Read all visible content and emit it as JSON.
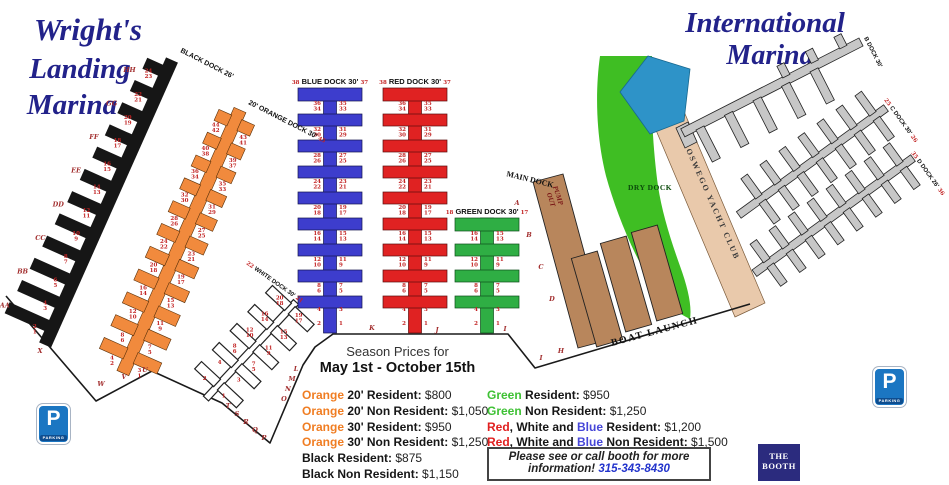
{
  "titles": {
    "left1": "Wright's",
    "left2": "Landing",
    "left3": "Marina",
    "right1": "International",
    "right2": "Marina"
  },
  "season": {
    "l1": "Season Prices for",
    "l2": "May 1st - October 15th"
  },
  "prices_left": [
    [
      {
        "t": "Orange",
        "c": "orange"
      },
      {
        "t": " 20' Resident: ",
        "c": "k"
      },
      {
        "t": "$800",
        "c": "v"
      }
    ],
    [
      {
        "t": "Orange",
        "c": "orange"
      },
      {
        "t": " 20' Non Resident: ",
        "c": "k"
      },
      {
        "t": "$1,050",
        "c": "v"
      }
    ],
    [
      {
        "t": "Orange",
        "c": "orange"
      },
      {
        "t": " 30' Resident: ",
        "c": "k"
      },
      {
        "t": "$950",
        "c": "v"
      }
    ],
    [
      {
        "t": "Orange",
        "c": "orange"
      },
      {
        "t": " 30' Non Resident: ",
        "c": "k"
      },
      {
        "t": "$1,250",
        "c": "v"
      }
    ],
    [
      {
        "t": "Black",
        "c": "k"
      },
      {
        "t": " Resident: ",
        "c": "k"
      },
      {
        "t": "$875",
        "c": "v"
      }
    ],
    [
      {
        "t": "Black",
        "c": "k"
      },
      {
        "t": " Non Resident: ",
        "c": "k"
      },
      {
        "t": "$1,150",
        "c": "v"
      }
    ]
  ],
  "prices_right": [
    [
      {
        "t": "Green",
        "c": "green"
      },
      {
        "t": " Resident: ",
        "c": "k"
      },
      {
        "t": "$950",
        "c": "v"
      }
    ],
    [
      {
        "t": "Green",
        "c": "green"
      },
      {
        "t": " Non Resident: ",
        "c": "k"
      },
      {
        "t": "$1,250",
        "c": "v"
      }
    ],
    [
      {
        "t": "Red",
        "c": "red"
      },
      {
        "t": ", White and ",
        "c": "k"
      },
      {
        "t": "Blue",
        "c": "blue"
      },
      {
        "t": " Resident: ",
        "c": "k"
      },
      {
        "t": "$1,200",
        "c": "v"
      }
    ],
    [
      {
        "t": "Red",
        "c": "red"
      },
      {
        "t": ", White and ",
        "c": "k"
      },
      {
        "t": "Blue",
        "c": "blue"
      },
      {
        "t": " Non Resident: ",
        "c": "k"
      },
      {
        "t": "$1,500",
        "c": "v"
      }
    ]
  ],
  "notice": {
    "l1": "Please see or call booth for more",
    "l2a": "information! ",
    "phone": "315-343-8430"
  },
  "booth": {
    "l1": "THE",
    "l2": "BOOTH"
  },
  "parking": {
    "p": "P",
    "label": "PARKING"
  },
  "map_labels": {
    "black": {
      "title": "BLACK DOCK 26'"
    },
    "orange": {
      "title": "20' ORANGE DOCK 30'",
      "num": "45"
    },
    "white": {
      "nl": "22",
      "title": "WHITE DOCK 30'",
      "nr": "21"
    },
    "blue": {
      "nl": "38",
      "title": "BLUE DOCK 30'",
      "nr": "37"
    },
    "red": {
      "nl": "38",
      "title": "RED DOCK 30'",
      "nr": "37"
    },
    "green": {
      "nl": "18",
      "title": "GREEN DOCK 30'",
      "nr": "17"
    },
    "main_dock": "MAIN DOCK",
    "pump1": "PUMP",
    "pump2": "OUT",
    "boat_launch": "BOAT LAUNCH",
    "dry_dock": "DRY DOCK",
    "yacht_club": "OSWEGO YACHT CLUB",
    "b_dock": "B DOCK 30'",
    "c_dock": {
      "nl": "25",
      "title": "C DOCK 30'",
      "nr": "26"
    },
    "d_dock": {
      "nl": "35",
      "title": "D DOCK 26'",
      "nr": "36"
    }
  },
  "slip_numbers": {
    "vpairs": [
      [
        "36",
        "34",
        "35",
        "33"
      ],
      [
        "32",
        "30",
        "31",
        "29"
      ],
      [
        "28",
        "26",
        "27",
        "25"
      ],
      [
        "24",
        "22",
        "23",
        "21"
      ],
      [
        "20",
        "18",
        "19",
        "17"
      ],
      [
        "16",
        "14",
        "15",
        "13"
      ],
      [
        "12",
        "10",
        "11",
        "9"
      ],
      [
        "8",
        "6",
        "7",
        "5"
      ]
    ],
    "vsingles": [
      [
        "4",
        "3"
      ],
      [
        "2",
        "1"
      ]
    ],
    "green_pairs": [
      [
        "16",
        "14",
        "15",
        "13"
      ],
      [
        "12",
        "10",
        "11",
        "9"
      ],
      [
        "8",
        "6",
        "7",
        "5"
      ]
    ],
    "black_pairs": [
      [
        "24",
        "23"
      ],
      [
        "22",
        "21"
      ],
      [
        "20",
        "19"
      ],
      [
        "18",
        "17"
      ],
      [
        "16",
        "15"
      ],
      [
        "14",
        "13"
      ],
      [
        "12",
        "11"
      ],
      [
        "10",
        "9"
      ],
      [
        "8",
        "7"
      ],
      [
        "6",
        "5"
      ],
      [
        "4",
        "3"
      ],
      [
        "2",
        "1"
      ]
    ],
    "orange_left": [
      [
        "44",
        "42"
      ],
      [
        "40",
        "38"
      ],
      [
        "36",
        "34"
      ],
      [
        "32",
        "30"
      ],
      [
        "28",
        "26"
      ],
      [
        "24",
        "22"
      ],
      [
        "20",
        "18"
      ],
      [
        "16",
        "14"
      ],
      [
        "12",
        "10"
      ],
      [
        "8",
        "6"
      ],
      [
        "4",
        "2"
      ]
    ],
    "orange_right": [
      [
        "43",
        "41"
      ],
      [
        "39",
        "37"
      ],
      [
        "35",
        "33"
      ],
      [
        "31",
        "29"
      ],
      [
        "27",
        "25"
      ],
      [
        "23",
        "21"
      ],
      [
        "19",
        "17"
      ],
      [
        "15",
        "13"
      ],
      [
        "11",
        "9"
      ],
      [
        "7",
        "5"
      ],
      [
        "3",
        "1"
      ]
    ],
    "white_left": [
      [
        "20",
        "18"
      ],
      [
        "16",
        "14"
      ],
      [
        "12",
        "10"
      ],
      [
        "8",
        "6"
      ],
      [
        "4"
      ],
      [
        "2"
      ]
    ],
    "white_right": [
      [
        "19",
        "17"
      ],
      [
        "15",
        "13"
      ],
      [
        "11",
        "9"
      ],
      [
        "7",
        "5"
      ],
      [
        "3"
      ],
      [
        "1"
      ]
    ]
  },
  "letters": {
    "black_side": [
      "HH",
      "GG",
      "FF",
      "EE",
      "DD",
      "CC",
      "BB",
      "AA"
    ],
    "shore": [
      "X",
      "W",
      "V",
      "U",
      "T",
      "S",
      "R",
      "Q",
      "P",
      "O",
      "N",
      "M",
      "L",
      "K",
      "J",
      "I",
      "I",
      "H"
    ],
    "main": [
      "A",
      "B",
      "C",
      "D"
    ]
  },
  "colors": {
    "navy_title": "#22228a",
    "blue_dock": "#3d3dcd",
    "red_dock": "#e02222",
    "green_dock": "#2fae44",
    "orange_dock": "#f18a3d",
    "brown_dock": "#b8865c",
    "grass": "#3fbe23",
    "tan_strip": "#e9c9ab",
    "clubhouse_blue": "#2e93c8",
    "parking_blue": "#1b76c2",
    "booth_navy": "#2b2b7e"
  }
}
